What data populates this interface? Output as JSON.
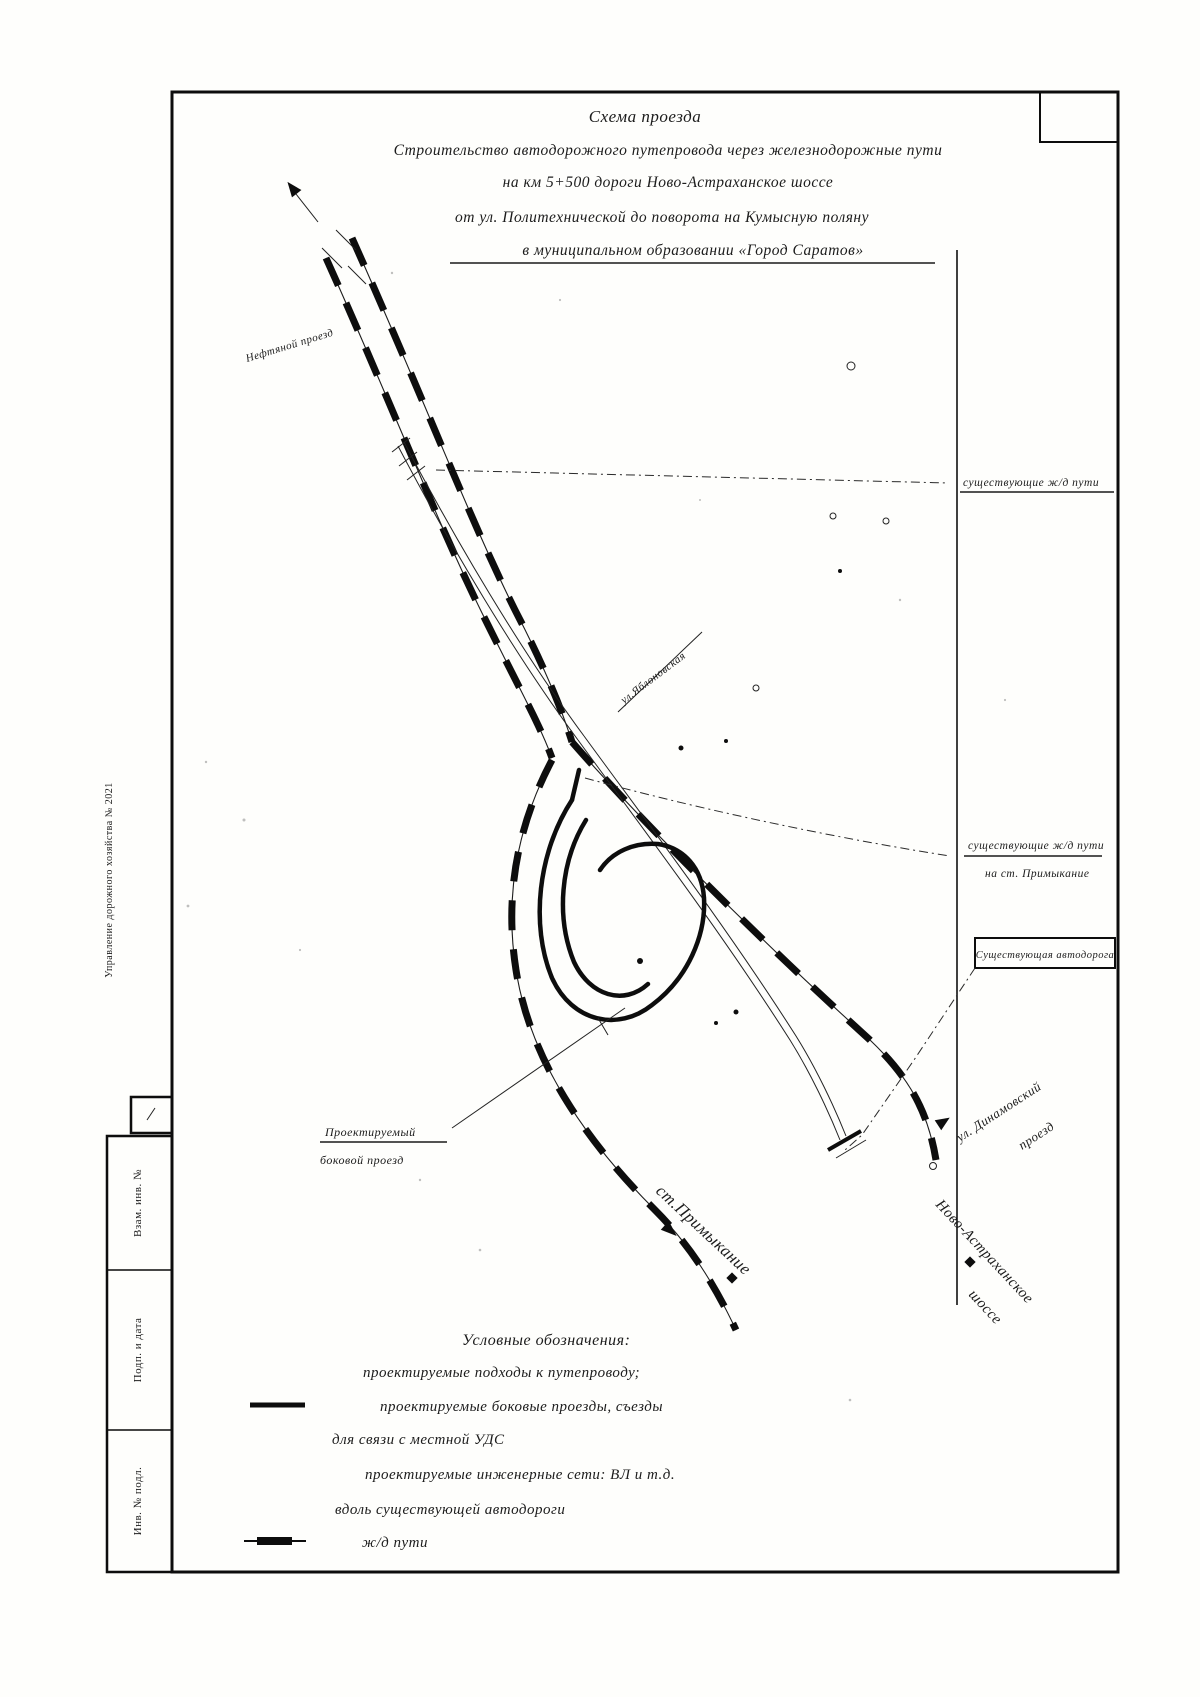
{
  "page": {
    "title": {
      "l1": "Схема проезда",
      "l2": "Строительство автодорожного путепровода через железнодорожные пути",
      "l3": "на км 5+500 дороги Ново-Астраханское шоссе",
      "l4": "от ул. Политехнической до поворота на Кумысную поляну",
      "l5": "в муниципальном образовании «Город Саратов»"
    },
    "map": {
      "labels": {
        "neftyanoy": "Нефтяной проезд",
        "yablonovskaya": "ул.Яблоновская",
        "primykanie": "ст.Примыкание",
        "novo_astrakhanskoe": "Ново-Астраханское",
        "shosse": "шоссе",
        "dinamovsky_1": "ул. Динамовский",
        "dinamovsky_2": "проезд",
        "proj_side_1": "Проектируемый",
        "proj_side_2": "боковой проезд"
      },
      "callouts": {
        "a": "существующие ж/д пути",
        "b1": "существующие ж/д пути",
        "b2": "на ст. Примыкание",
        "c": "Существующая автодорога"
      }
    },
    "legend": {
      "title": "Условные обозначения:",
      "item1": "проектируемые подходы к путепроводу;",
      "item2": "проектируемые боковые проезды, съезды",
      "item3": "для связи с местной УДС",
      "item4": "проектируемые инженерные сети: ВЛ и т.д.",
      "item5": "вдоль существующей автодороги",
      "item6": "ж/д пути"
    },
    "stamp": {
      "doc_line": "Управление дорожного хозяйства № 2021",
      "cell_top": "Взам. инв. №",
      "cell_mid": "Подп. и дата",
      "cell_bottom": "Инв. № подл."
    }
  }
}
